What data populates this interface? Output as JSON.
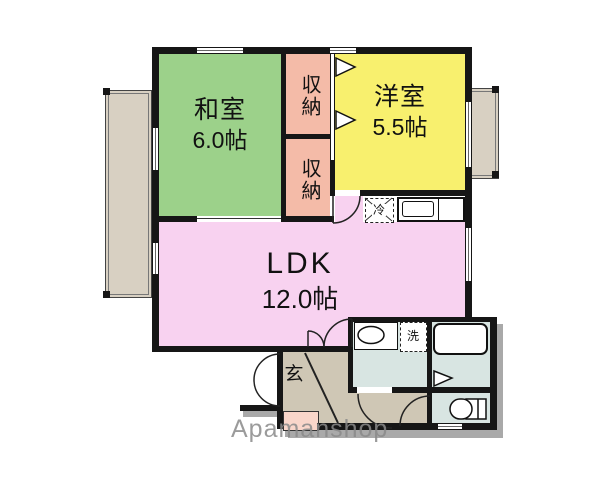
{
  "watermark": "Apamanshop",
  "rooms": {
    "washitsu": {
      "name": "和室",
      "size": "6.0帖"
    },
    "closet_upper": {
      "name": "収納"
    },
    "closet_lower": {
      "name": "収納"
    },
    "youshitsu": {
      "name": "洋室",
      "size": "5.5帖"
    },
    "ldk": {
      "name": "LDK",
      "size": "12.0帖"
    },
    "genkan": {
      "name": "玄"
    }
  },
  "fixtures": {
    "refrigerator": "冷",
    "washing_machine": "洗"
  },
  "colors": {
    "wall": "#161616",
    "washitsu": "#9cd18a",
    "closet": "#f4bba8",
    "youshitsu": "#f8f06e",
    "ldk": "#f8d2f0",
    "wet_area": "#d8e5e2",
    "hall": "#cfc7b5",
    "balcony": "#d8d0c2",
    "step": "#f9d6ca",
    "shadow": "#a9a9a9",
    "watermark": "#8a8a8a"
  }
}
